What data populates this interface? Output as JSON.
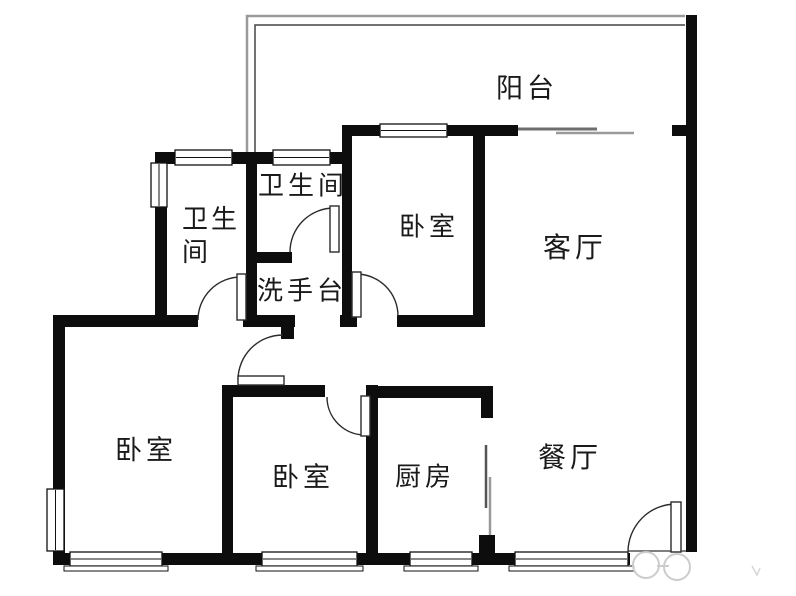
{
  "colors": {
    "background": "#ffffff",
    "wall": "#0d0d0d",
    "window_border": "#111111",
    "door_arc": "#2b2b2b",
    "label": "#1a1a1a",
    "watermark": "#cccccc"
  },
  "rooms": [
    {
      "id": "balcony",
      "label": "阳台"
    },
    {
      "id": "bathroom-right",
      "label": "卫生间"
    },
    {
      "id": "bathroom-left",
      "label": "卫生间",
      "lines": [
        "卫生",
        "间"
      ]
    },
    {
      "id": "washstand",
      "label": "洗手台"
    },
    {
      "id": "bedroom-top",
      "label": "卧室"
    },
    {
      "id": "living-room",
      "label": "客厅"
    },
    {
      "id": "bedroom-left",
      "label": "卧室"
    },
    {
      "id": "bedroom-middle",
      "label": "卧室"
    },
    {
      "id": "kitchen",
      "label": "厨房"
    },
    {
      "id": "dining-room",
      "label": "餐厅"
    }
  ],
  "plan": {
    "width": 796,
    "height": 596,
    "walls": [
      {
        "name": "wall-right",
        "x": 686,
        "y": 15,
        "w": 11,
        "h": 537
      },
      {
        "name": "wall-bedroom-top-north",
        "x": 342,
        "y": 125,
        "w": 176,
        "h": 11
      },
      {
        "name": "wall-balcony-stub",
        "x": 672,
        "y": 125,
        "w": 14,
        "h": 11
      },
      {
        "name": "wall-bathrooms-north",
        "x": 155,
        "y": 152,
        "w": 197,
        "h": 12
      },
      {
        "name": "wall-bathroom-left-west",
        "x": 155,
        "y": 152,
        "w": 12,
        "h": 166
      },
      {
        "name": "wall-bathrooms-middle",
        "x": 246,
        "y": 152,
        "w": 11,
        "h": 168
      },
      {
        "name": "wall-bedroom-top-west",
        "x": 342,
        "y": 125,
        "w": 10,
        "h": 202
      },
      {
        "name": "wall-living-west",
        "x": 473,
        "y": 136,
        "w": 12,
        "h": 191
      },
      {
        "name": "wall-bedroom-top-south",
        "x": 397,
        "y": 315,
        "w": 88,
        "h": 12
      },
      {
        "name": "wall-bedroom-top-door-stub",
        "x": 340,
        "y": 315,
        "w": 17,
        "h": 12
      },
      {
        "name": "wall-bathroom-right-south",
        "x": 257,
        "y": 252,
        "w": 35,
        "h": 11
      },
      {
        "name": "wall-hall-north-west",
        "x": 53,
        "y": 315,
        "w": 145,
        "h": 12
      },
      {
        "name": "wall-hall-north-east",
        "x": 243,
        "y": 315,
        "w": 52,
        "h": 12
      },
      {
        "name": "wall-hall-door-stub",
        "x": 281,
        "y": 327,
        "w": 13,
        "h": 12
      },
      {
        "name": "wall-west",
        "x": 53,
        "y": 315,
        "w": 12,
        "h": 250
      },
      {
        "name": "wall-south",
        "x": 53,
        "y": 553,
        "w": 577,
        "h": 12
      },
      {
        "name": "wall-bedrooms-shared",
        "x": 222,
        "y": 385,
        "w": 11,
        "h": 180
      },
      {
        "name": "wall-bedroom-mid-north",
        "x": 222,
        "y": 385,
        "w": 103,
        "h": 12
      },
      {
        "name": "wall-kitchen-west",
        "x": 366,
        "y": 385,
        "w": 12,
        "h": 180
      },
      {
        "name": "wall-kitchen-north",
        "x": 366,
        "y": 386,
        "w": 127,
        "h": 12
      },
      {
        "name": "wall-kitchen-stub-north",
        "x": 481,
        "y": 386,
        "w": 12,
        "h": 32
      },
      {
        "name": "wall-kitchen-stub-south",
        "x": 479,
        "y": 535,
        "w": 16,
        "h": 19
      }
    ],
    "windows": [
      {
        "name": "window-bathroom-left-north",
        "x": 175,
        "y": 150,
        "w": 57,
        "h": 15,
        "o": "h"
      },
      {
        "name": "window-bathroom-right-north",
        "x": 273,
        "y": 150,
        "w": 57,
        "h": 15,
        "o": "h"
      },
      {
        "name": "window-bedroom-top-north",
        "x": 380,
        "y": 124,
        "w": 67,
        "h": 13,
        "o": "h"
      },
      {
        "name": "window-bathroom-left-west",
        "x": 151,
        "y": 163,
        "w": 16,
        "h": 44,
        "o": "v"
      },
      {
        "name": "window-bedroom-left-west",
        "x": 47,
        "y": 489,
        "w": 17,
        "h": 62,
        "o": "v"
      },
      {
        "name": "window-bedroom-left-south",
        "x": 70,
        "y": 552,
        "w": 92,
        "h": 14,
        "o": "h",
        "sill": [
          64,
          566,
          104,
          5
        ]
      },
      {
        "name": "window-bedroom-mid-south",
        "x": 262,
        "y": 552,
        "w": 95,
        "h": 14,
        "o": "h",
        "sill": [
          256,
          566,
          107,
          5
        ]
      },
      {
        "name": "window-kitchen-south",
        "x": 410,
        "y": 552,
        "w": 62,
        "h": 14,
        "o": "h",
        "sill": [
          404,
          566,
          74,
          5
        ]
      },
      {
        "name": "window-dining-south",
        "x": 515,
        "y": 552,
        "w": 113,
        "h": 14,
        "o": "h",
        "sill": [
          509,
          566,
          125,
          5
        ]
      }
    ],
    "doors": [
      {
        "name": "door-entry",
        "arc": "M 628 552 A 48 48 0 0 1 676 504",
        "leaf": [
          671,
          502,
          10,
          50
        ]
      },
      {
        "name": "door-bathroom-left",
        "arc": "M 198 320 A 43 43 0 0 1 241 277",
        "leaf": [
          237,
          274,
          9,
          46
        ]
      },
      {
        "name": "door-bathroom-right",
        "arc": "M 290 252 A 44 44 0 0 1 334 208",
        "leaf": [
          330,
          206,
          9,
          46
        ]
      },
      {
        "name": "door-bedroom-top",
        "arc": "M 356 274 A 42 42 0 0 1 398 316",
        "leaf": [
          352,
          272,
          9,
          45
        ]
      },
      {
        "name": "door-bedroom-mid",
        "arc": "M 327 397 A 38 38 0 0 0 365 435",
        "leaf": [
          361,
          396,
          9,
          40
        ]
      },
      {
        "name": "door-hall",
        "arc": "M 238 380 A 45 45 0 0 1 283 335",
        "leaf": [
          238,
          376,
          46,
          9
        ]
      }
    ],
    "lines": [
      {
        "name": "balcony-outline-outer",
        "d": "M 247 155 L 247 16 L 685 16",
        "stroke": "#9a9a9a",
        "w": 2.5
      },
      {
        "name": "balcony-outline-inner",
        "d": "M 255 155 L 255 25 L 685 25",
        "stroke": "#444444",
        "w": 1.5
      },
      {
        "name": "balcony-sliding-panel-1",
        "d": "M 518 129 L 597 129",
        "stroke": "#6e6e6e",
        "w": 3
      },
      {
        "name": "balcony-sliding-panel-2",
        "d": "M 556 133 L 634 133",
        "stroke": "#9a9a9a",
        "w": 2.5
      },
      {
        "name": "kitchen-sliding-panel-1",
        "d": "M 486 445 L 486 508",
        "stroke": "#555555",
        "w": 2.5
      },
      {
        "name": "kitchen-sliding-panel-2",
        "d": "M 490 477 L 490 537",
        "stroke": "#9a9a9a",
        "w": 2.5
      },
      {
        "name": "entry-threshold",
        "d": "M 628 551 L 686 551",
        "stroke": "#555555",
        "w": 1.5
      }
    ],
    "watermark": [
      {
        "name": "watermark-logo-left",
        "d": "M 633 565 a 13 13 0 1 0 26 0 a 13 13 0 1 0 -26 0",
        "stroke": "#cccccc",
        "w": 2,
        "fill": "rgba(255,255,255,0.65)"
      },
      {
        "name": "watermark-logo-right",
        "d": "M 664 567 a 13 13 0 1 0 26 0 a 13 13 0 1 0 -26 0",
        "stroke": "#cccccc",
        "w": 2,
        "fill": "rgba(255,255,255,0.65)"
      },
      {
        "name": "watermark-dash",
        "d": "M 657 566 L 669 566",
        "stroke": "#cccccc",
        "w": 2,
        "fill": "none"
      },
      {
        "name": "watermark-tick",
        "d": "M 752 566 L 757 575 L 760 568",
        "stroke": "#d6d6d6",
        "w": 1.5,
        "fill": "none"
      }
    ]
  }
}
